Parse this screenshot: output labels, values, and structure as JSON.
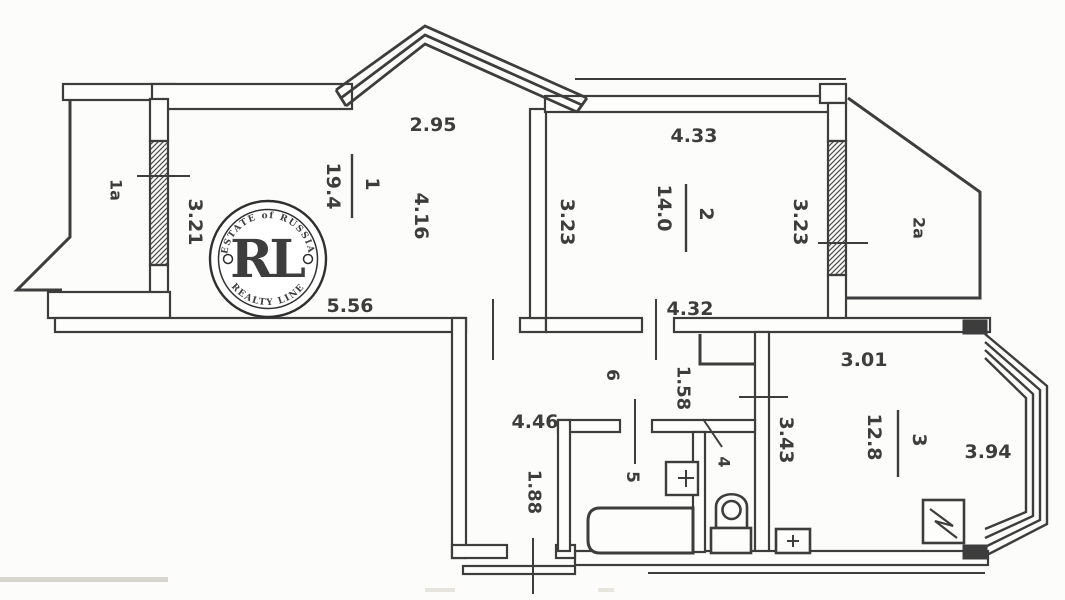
{
  "watermark": {
    "arc_top": "ESTATE of RUSSIA",
    "arc_bottom": "REALTY LINE",
    "monogram": "RL"
  },
  "rooms": {
    "room1": {
      "number": "1",
      "area": "19.4",
      "dim_top": "2.95",
      "dim_side": "4.16",
      "dim_left": "3.21",
      "dim_bottom": "5.56"
    },
    "room2": {
      "number": "2",
      "area": "14.0",
      "dim_top": "4.33",
      "dim_left": "3.23",
      "dim_right": "3.23",
      "dim_bottom": "4.32"
    },
    "room3": {
      "number": "3",
      "area": "12.8",
      "dim_top": "3.01",
      "dim_left": "3.43",
      "dim_right": "3.94"
    },
    "room4": {
      "number": "4"
    },
    "room5": {
      "number": "5"
    },
    "room6": {
      "number": "6",
      "dim_width": "4.46",
      "dim_closet": "1.58",
      "dim_lower": "1.88"
    },
    "balcony1a": {
      "number": "1a"
    },
    "balcony2a": {
      "number": "2a"
    }
  },
  "colors": {
    "wall": "#3c3c3c",
    "background": "#fcfcfb",
    "gold": "#c49a3e",
    "badge_text": "#a2946a"
  }
}
